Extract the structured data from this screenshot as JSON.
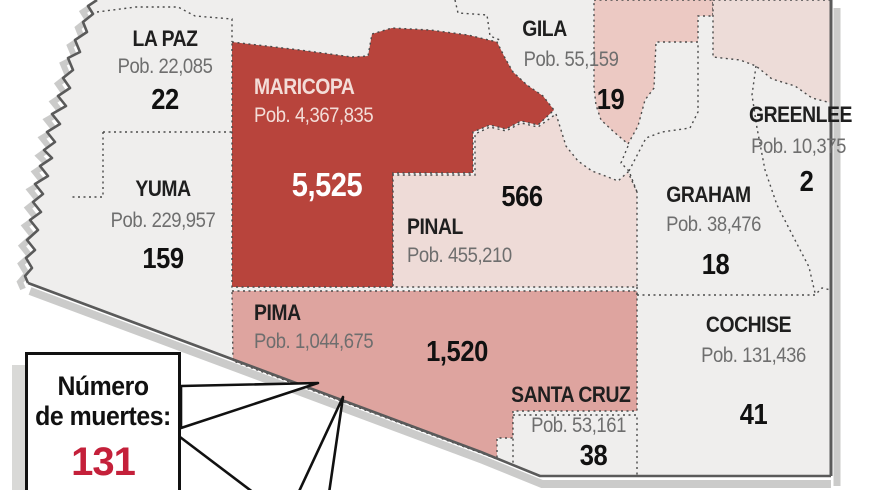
{
  "callout": {
    "label_line1": "Número",
    "label_line2": "de muertes:",
    "value": "131"
  },
  "colors": {
    "maricopa_red": "#b8443c",
    "pinal_pink": "#eedbd7",
    "pima_pink": "#dea49f",
    "navajo_pink": "#ecc9c3",
    "apache_pink": "#eddcd8",
    "state_bg": "#efeeed",
    "deaths_red": "#c4203a",
    "border_gray": "#5a5a5a",
    "shadow_gray": "#cbcbca"
  },
  "counties": [
    {
      "id": "la-paz",
      "name": "LA PAZ",
      "population": "Pob. 22,085",
      "deaths": "22"
    },
    {
      "id": "yuma",
      "name": "YUMA",
      "population": "Pob. 229,957",
      "deaths": "159"
    },
    {
      "id": "maricopa",
      "name": "MARICOPA",
      "population": "Pob. 4,367,835",
      "deaths": "5,525"
    },
    {
      "id": "pinal",
      "name": "PINAL",
      "population": "Pob. 455,210",
      "deaths": "566"
    },
    {
      "id": "gila",
      "name": "GILA",
      "population": "Pob. 55,159",
      "deaths": "19"
    },
    {
      "id": "greenlee",
      "name": "GREENLEE",
      "population": "Pob. 10,375",
      "deaths": "2"
    },
    {
      "id": "graham",
      "name": "GRAHAM",
      "population": "Pob. 38,476",
      "deaths": "18"
    },
    {
      "id": "pima",
      "name": "PIMA",
      "population": "Pob. 1,044,675",
      "deaths": "1,520"
    },
    {
      "id": "cochise",
      "name": "COCHISE",
      "population": "Pob. 131,436",
      "deaths": "41"
    },
    {
      "id": "santa-cruz",
      "name": "SANTA CRUZ",
      "population": "Pob. 53,161",
      "deaths": "38"
    }
  ]
}
